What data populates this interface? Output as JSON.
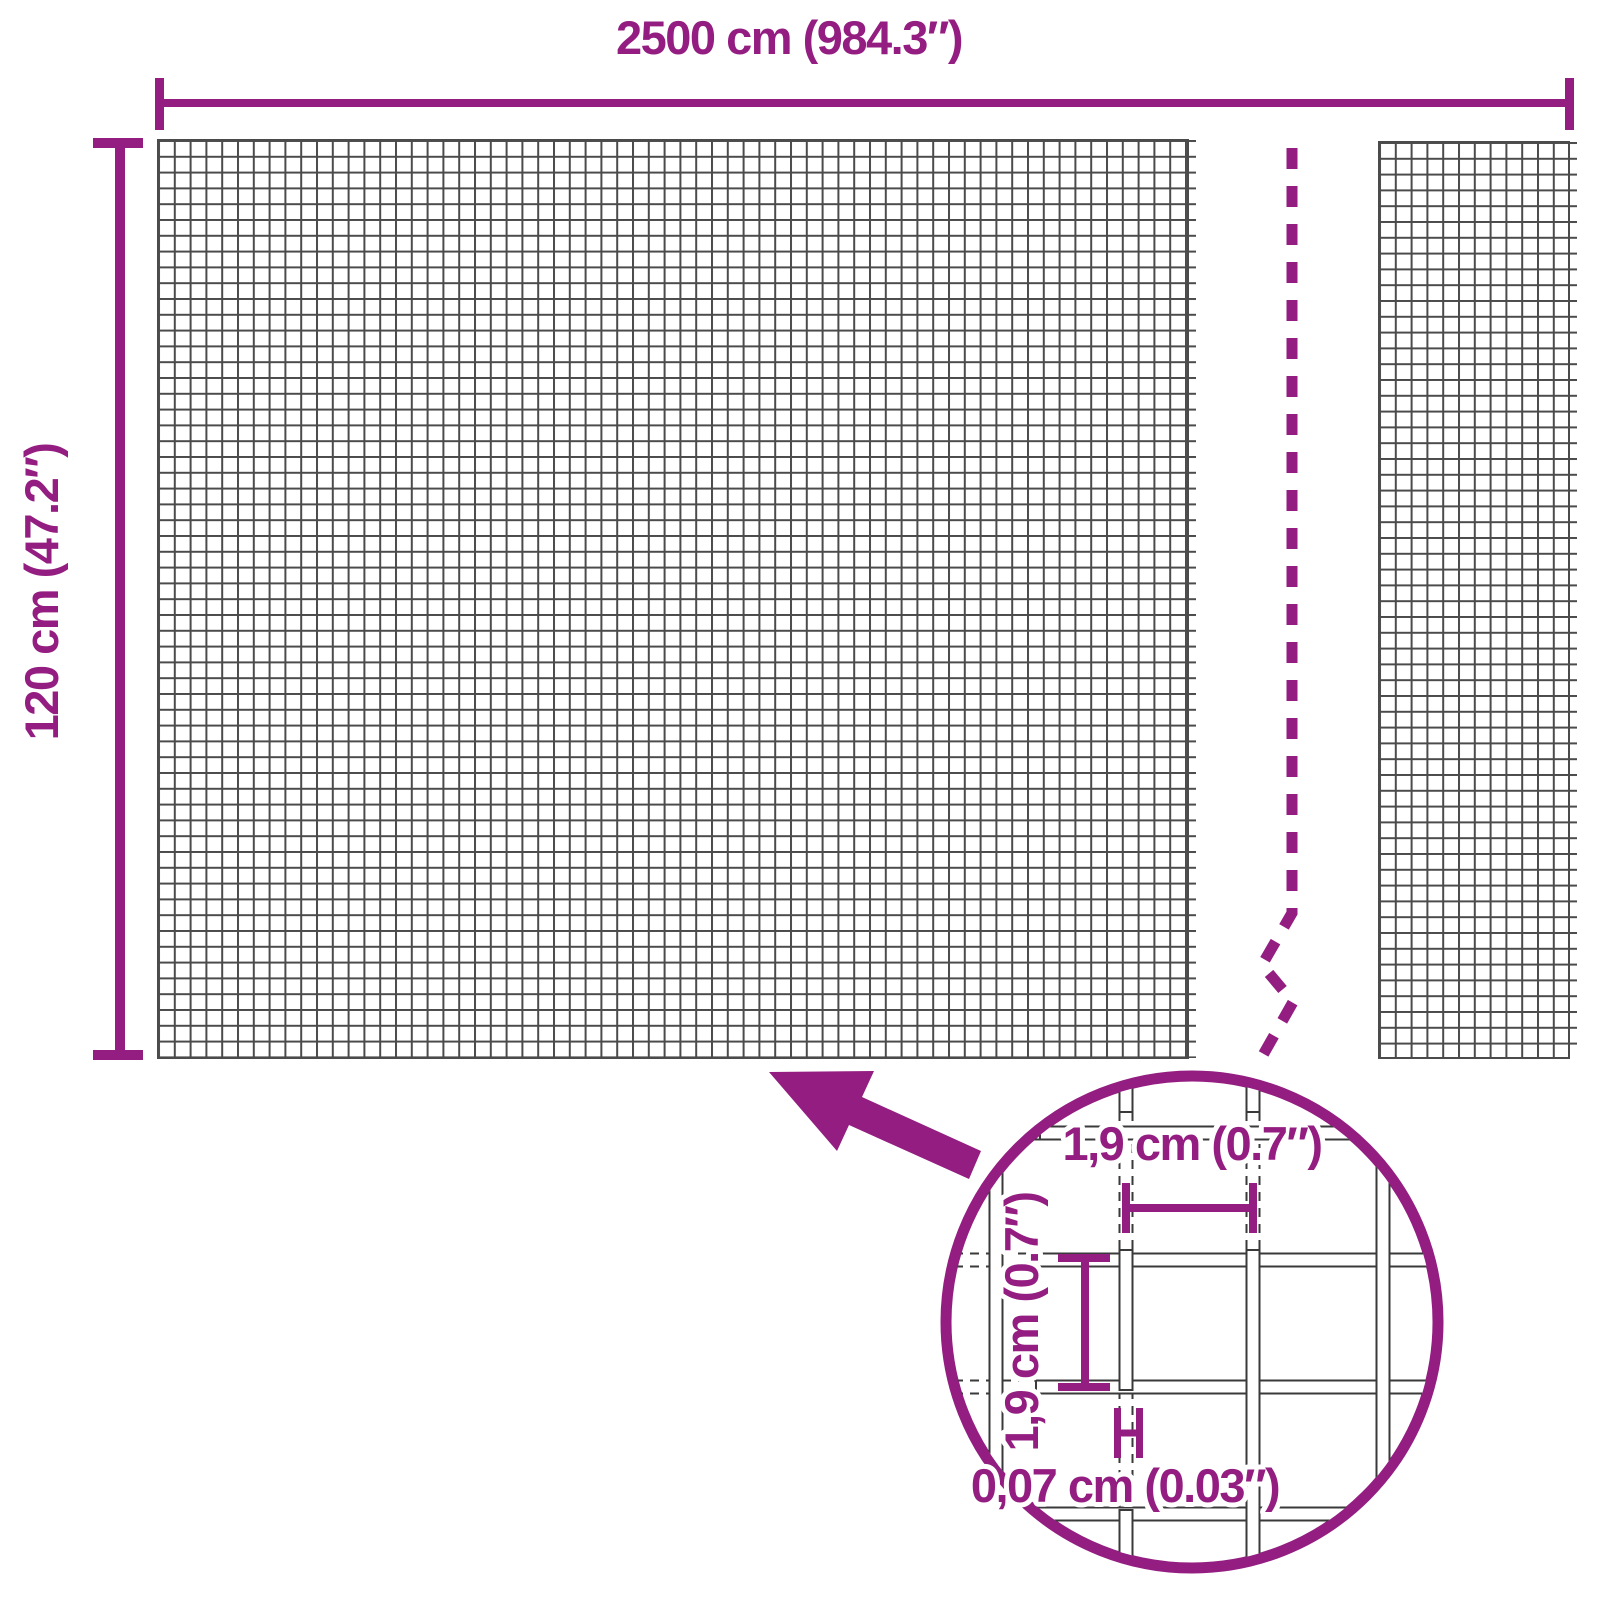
{
  "labels": {
    "total_width": "2500 cm (984.3″)",
    "total_height": "120 cm (47.2″)",
    "mesh_opening_width": "1,9 cm (0.7″)",
    "mesh_opening_height": "1,9 cm (0.7″)",
    "wire_thickness": "0,07 cm (0.03″)"
  },
  "colors": {
    "accent": "#931d80",
    "mesh_line": "#4b4b4b",
    "wire_outline": "#3a3a3a",
    "background": "#ffffff"
  }
}
